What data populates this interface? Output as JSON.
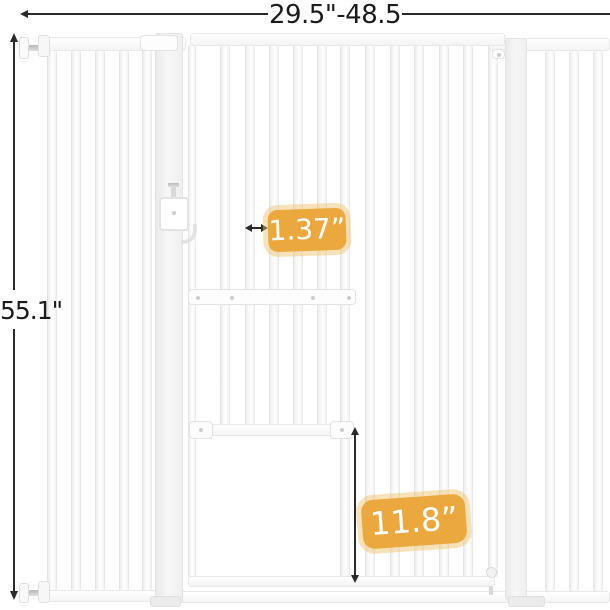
{
  "dimensions": {
    "width_range": {
      "label": "29.5\"-48.5"
    },
    "overall_height": {
      "label": "55.1\""
    },
    "bar_spacing": {
      "label": "1.37”"
    },
    "cat_door_height": {
      "label": "11.8”"
    }
  },
  "colors": {
    "badge_background": "#EAA83E",
    "badge_halo": "rgba(240,190,100,0.45)",
    "badge_text": "#FFFFFF",
    "dimension_line": "#2A2A2A",
    "dimension_text": "#1B1B1B"
  }
}
